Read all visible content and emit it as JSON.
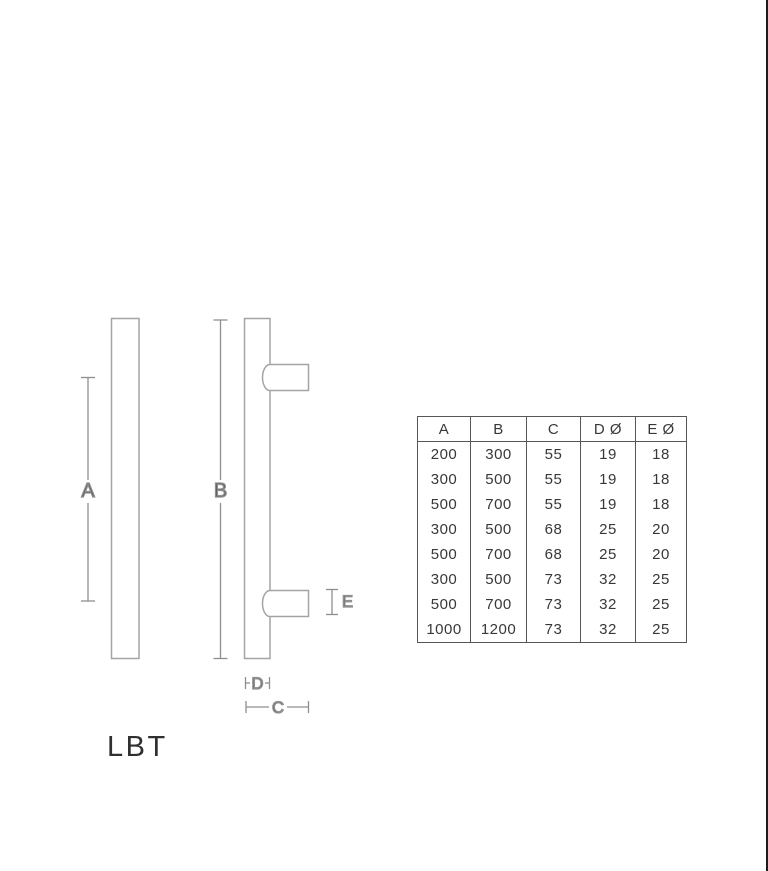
{
  "product": {
    "name": "LBT"
  },
  "diagram": {
    "dim_labels": {
      "a": "A",
      "b": "B",
      "c": "C",
      "d": "D",
      "e": "E"
    }
  },
  "spec_table": {
    "headers": [
      "A",
      "B",
      "C",
      "D Ø",
      "E Ø"
    ],
    "rows": [
      [
        "200",
        "300",
        "55",
        "19",
        "18"
      ],
      [
        "300",
        "500",
        "55",
        "19",
        "18"
      ],
      [
        "500",
        "700",
        "55",
        "19",
        "18"
      ],
      [
        "300",
        "500",
        "68",
        "25",
        "20"
      ],
      [
        "500",
        "700",
        "68",
        "25",
        "20"
      ],
      [
        "300",
        "500",
        "73",
        "32",
        "25"
      ],
      [
        "500",
        "700",
        "73",
        "32",
        "25"
      ],
      [
        "1000",
        "1200",
        "73",
        "32",
        "25"
      ]
    ]
  },
  "colors": {
    "background": "#ffffff",
    "drawing_outline": "#a4a4a4",
    "dimension_line": "#8f8f8f",
    "label_text": "#3d3d3d",
    "table_border": "#565656",
    "edge_strip": "#1c1c1c"
  }
}
